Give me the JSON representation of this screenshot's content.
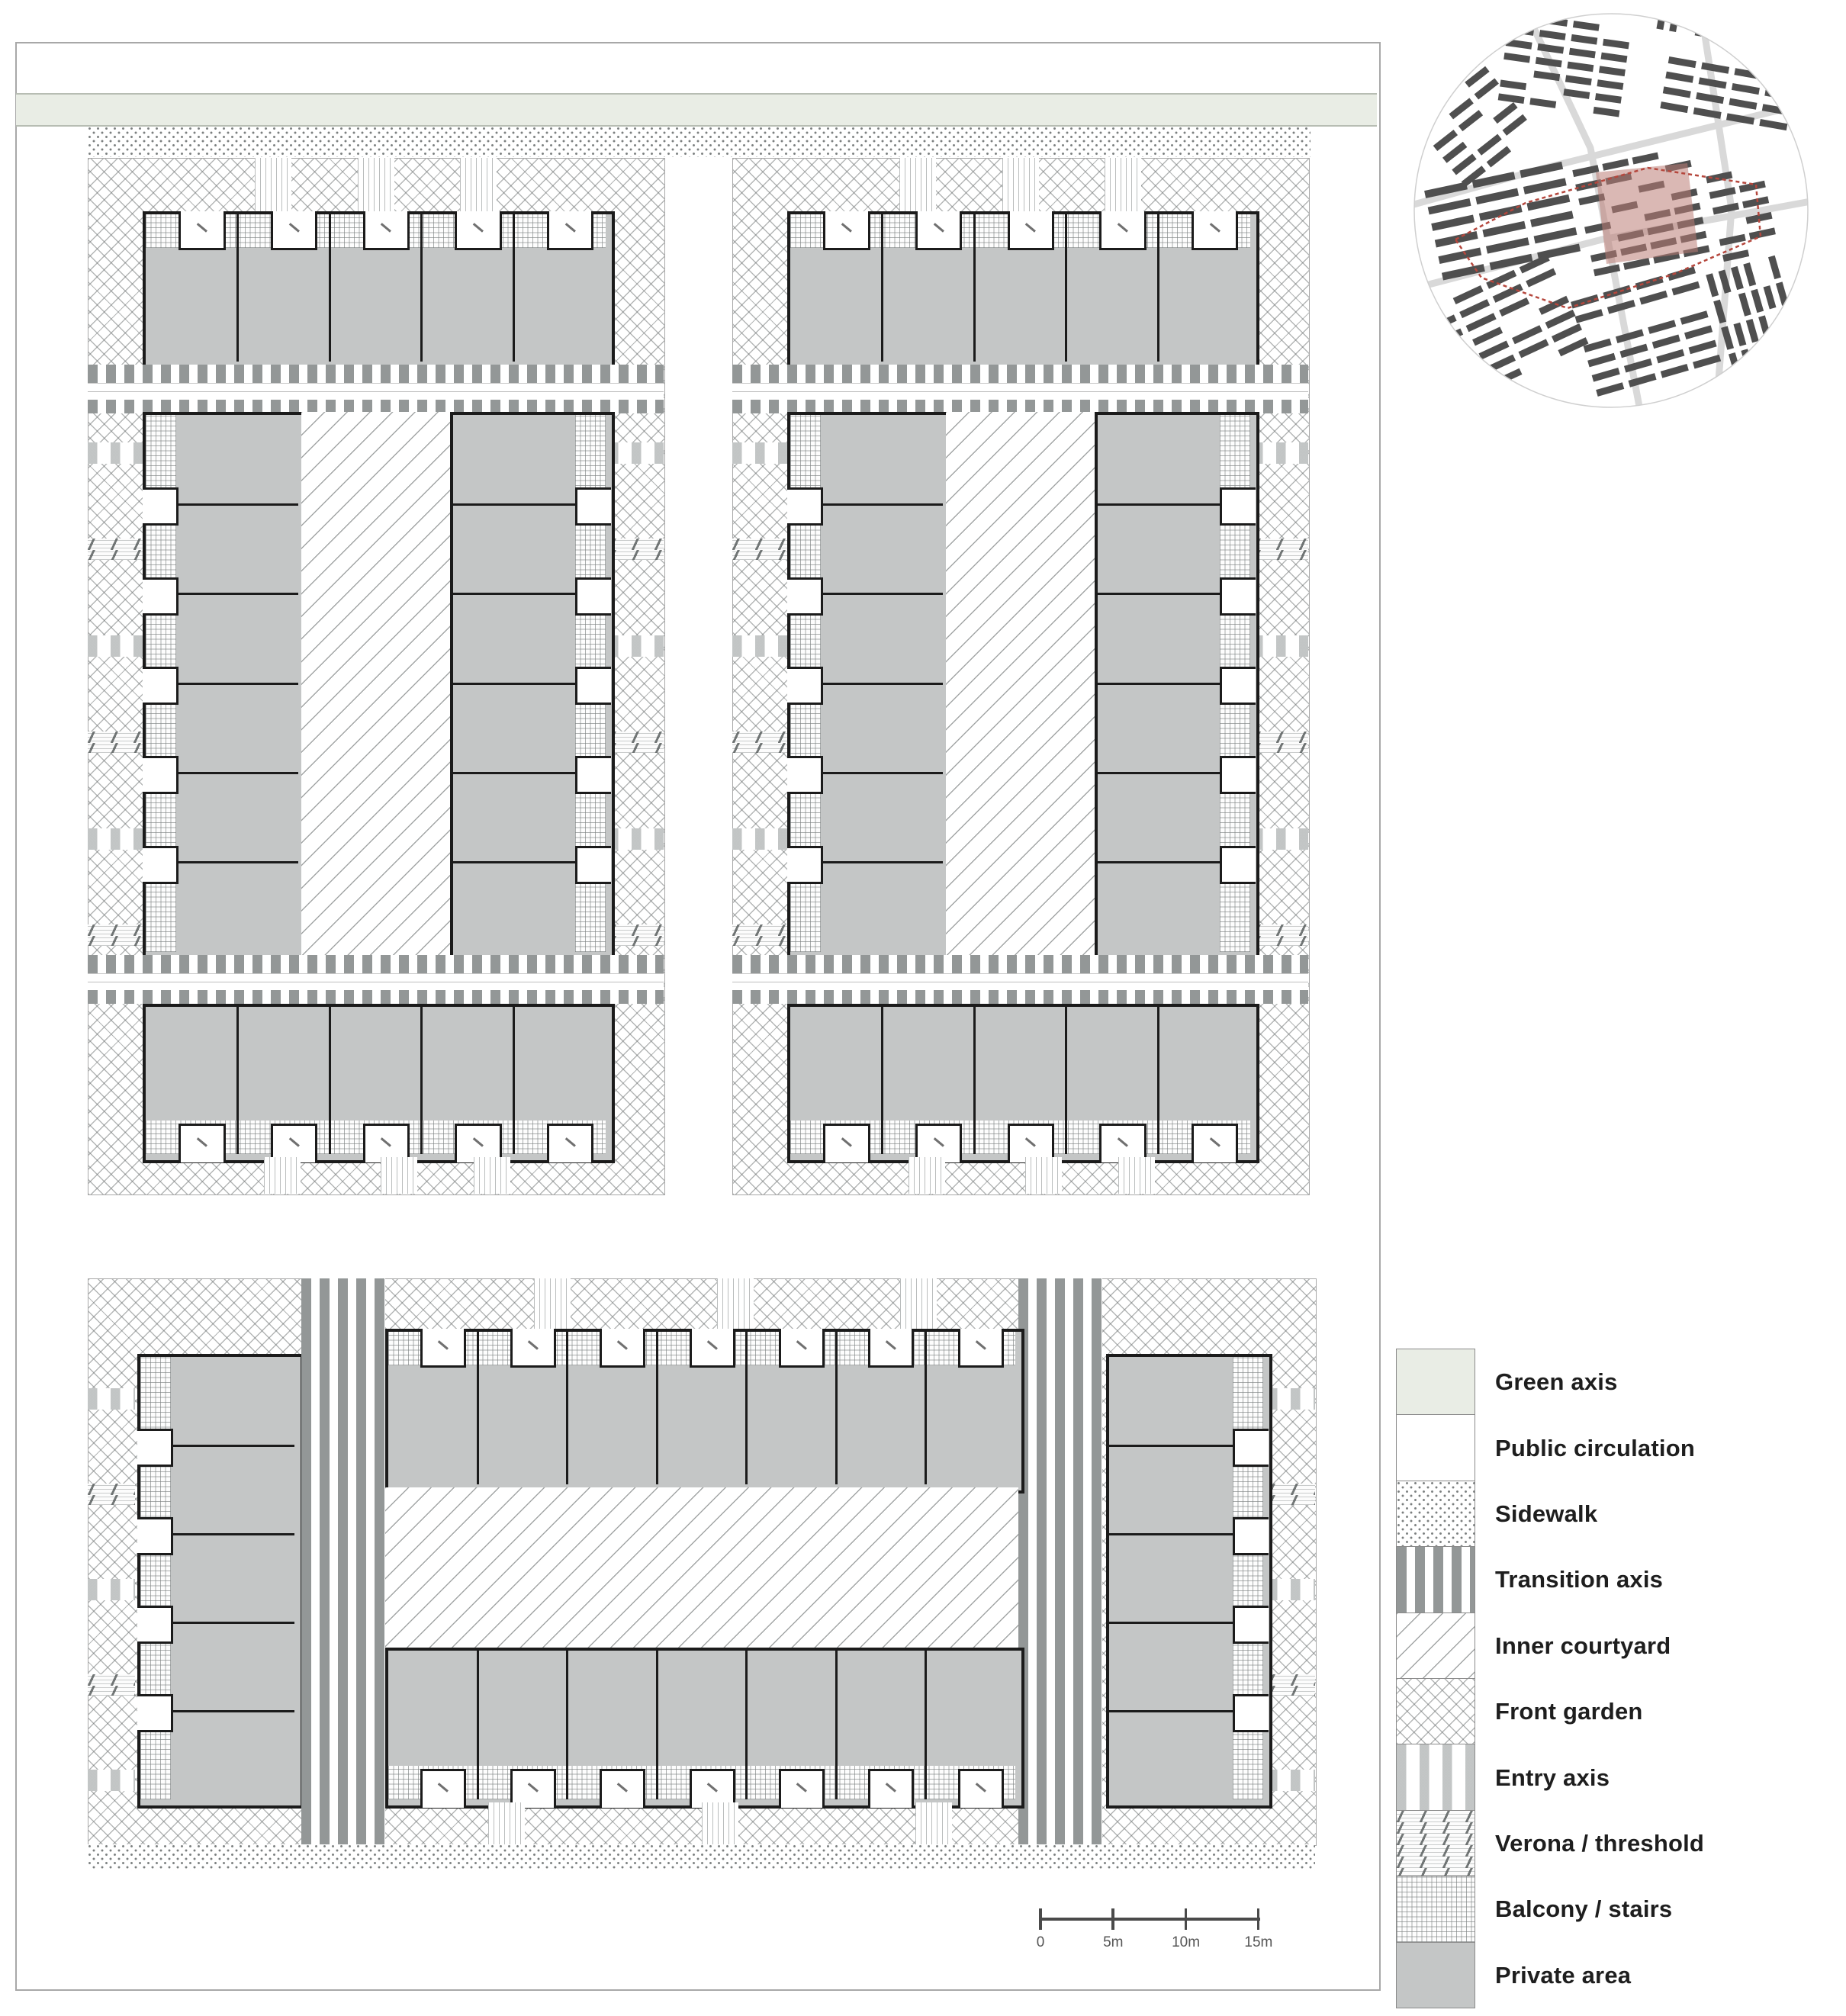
{
  "title": "Housing block site plan with spatial hierarchy legend",
  "colors": {
    "private_area": "#c4c6c6",
    "outline": "#1b1b1b",
    "green_axis": "#e9ede5",
    "hatch_line": "#6e7373",
    "page_border": "#a8a8a8",
    "map_building": "#4f4f4f",
    "map_boundary_red": "#b5473d",
    "map_highlight_pink": "#bc7d77",
    "map_street": "#d9d9d9"
  },
  "legend": {
    "items": [
      {
        "key": "green",
        "label": "Green axis"
      },
      {
        "key": "pub",
        "label": "Public circulation"
      },
      {
        "key": "sidewalk",
        "label": "Sidewalk"
      },
      {
        "key": "trans",
        "label": "Transition axis"
      },
      {
        "key": "court",
        "label": "Inner courtyard"
      },
      {
        "key": "xh",
        "label": "Front garden"
      },
      {
        "key": "entry",
        "label": "Entry axis"
      },
      {
        "key": "verona",
        "label": "Verona / threshold"
      },
      {
        "key": "balc",
        "label": "Balcony / stairs"
      },
      {
        "key": "priv",
        "label": "Private area"
      }
    ]
  },
  "scale_bar": {
    "labels": [
      "0",
      "5m",
      "10m",
      "15m"
    ]
  },
  "plan": {
    "upper_blocks": [
      {
        "id": "upper-left",
        "top_row_units": 5,
        "wing_units": 6,
        "bottom_row_units": 5
      },
      {
        "id": "upper-right",
        "top_row_units": 5,
        "wing_units": 6,
        "bottom_row_units": 5
      }
    ],
    "lower_block": {
      "id": "lower",
      "top_row_units": 7,
      "bottom_row_units": 7,
      "side_wing_units": 5
    }
  },
  "context_map": {
    "name": "location-inset-map",
    "highlighted_area": "project site"
  }
}
